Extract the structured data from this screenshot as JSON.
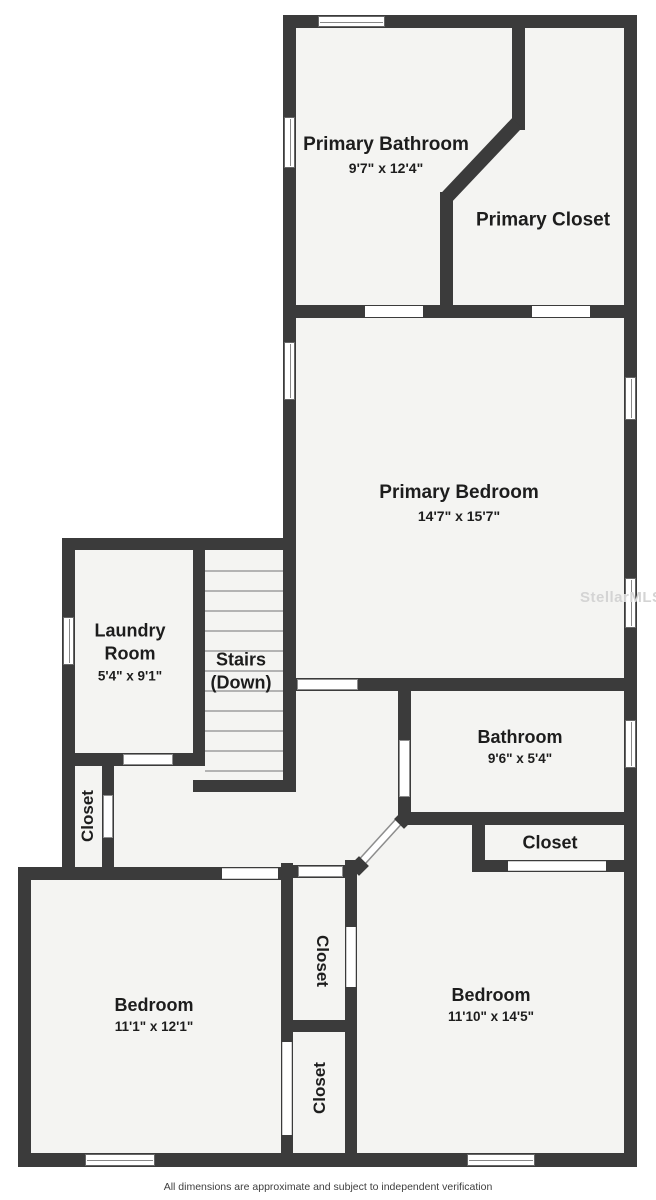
{
  "rooms": {
    "primary_bathroom": {
      "name": "Primary Bathroom",
      "dims": "9'7\" x 12'4\""
    },
    "primary_closet": {
      "name": "Primary Closet"
    },
    "primary_bedroom": {
      "name": "Primary Bedroom",
      "dims": "14'7\" x 15'7\""
    },
    "laundry": {
      "name": "Laundry Room",
      "dims": "5'4\" x 9'1\""
    },
    "stairs": {
      "name": "Stairs (Down)"
    },
    "bathroom": {
      "name": "Bathroom",
      "dims": "9'6\" x 5'4\""
    },
    "closet_right": {
      "name": "Closet"
    },
    "closet_left": {
      "name": "Closet"
    },
    "closet_center_upper": {
      "name": "Closet"
    },
    "closet_center_lower": {
      "name": "Closet"
    },
    "bedroom_left": {
      "name": "Bedroom",
      "dims": "11'1\" x 12'1\""
    },
    "bedroom_right": {
      "name": "Bedroom",
      "dims": "11'10\" x 14'5\""
    }
  },
  "watermark": "StellarMLS",
  "footer": "All dimensions are approximate and subject to independent verification",
  "colors": {
    "wall": "#3b3b3b",
    "floor": "#f4f4f2",
    "bg": "#ffffff",
    "label": "#1d1d1d"
  }
}
